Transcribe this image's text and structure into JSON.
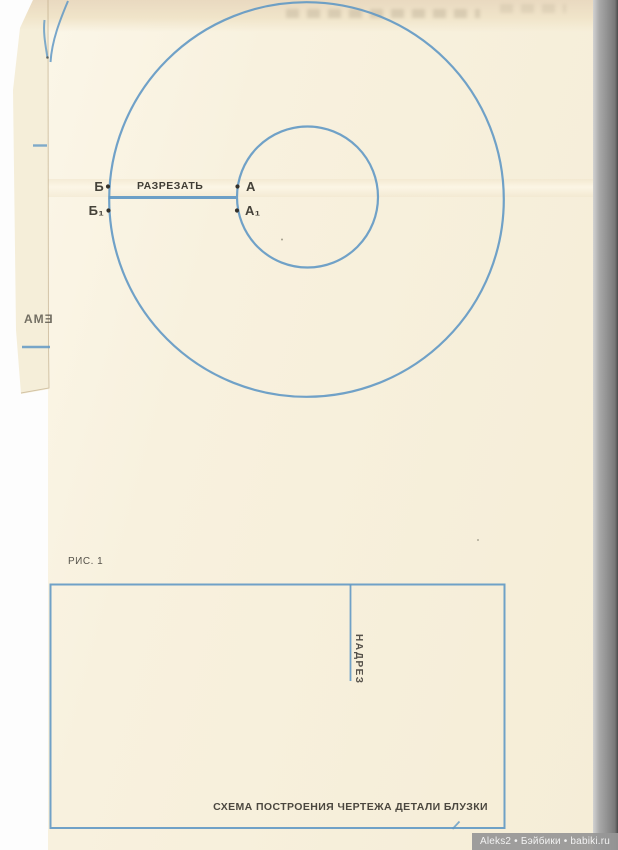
{
  "colors": {
    "line_blue": "#6098c4",
    "paper": "#f8f1de",
    "ink": "#45423a"
  },
  "fig1": {
    "caption": "РИС. 1",
    "cut_instruction": "РАЗРЕЗАТЬ",
    "point_b": "Б",
    "point_b1": "Б₁",
    "point_a": "А",
    "point_a1": "А₁"
  },
  "fig2": {
    "notch_label": "НАДРЕЗ",
    "caption": "СХЕМА ПОСТРОЕНИЯ ЧЕРТЕЖА ДЕТАЛИ БЛУЗКИ"
  },
  "left_sheet": {
    "bleedthrough_text": "ЕМА"
  },
  "watermark": {
    "text": "Aleks2 • Бэйбики • babiki.ru"
  }
}
